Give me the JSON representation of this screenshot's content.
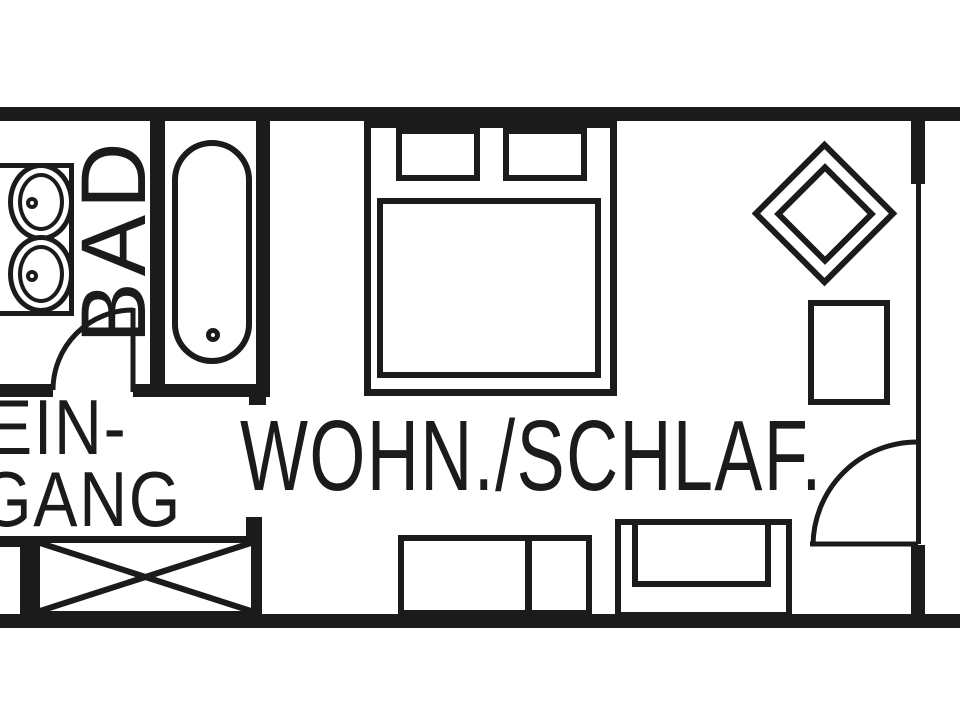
{
  "floorplan": {
    "labels": {
      "bathroom": "BAD",
      "entrance_line1": "EIN-",
      "entrance_line2": "GANG",
      "living_sleeping": "WOHN./SCHLAF."
    },
    "colors": {
      "background": "#ffffff",
      "line": "#1b1b1b"
    }
  }
}
